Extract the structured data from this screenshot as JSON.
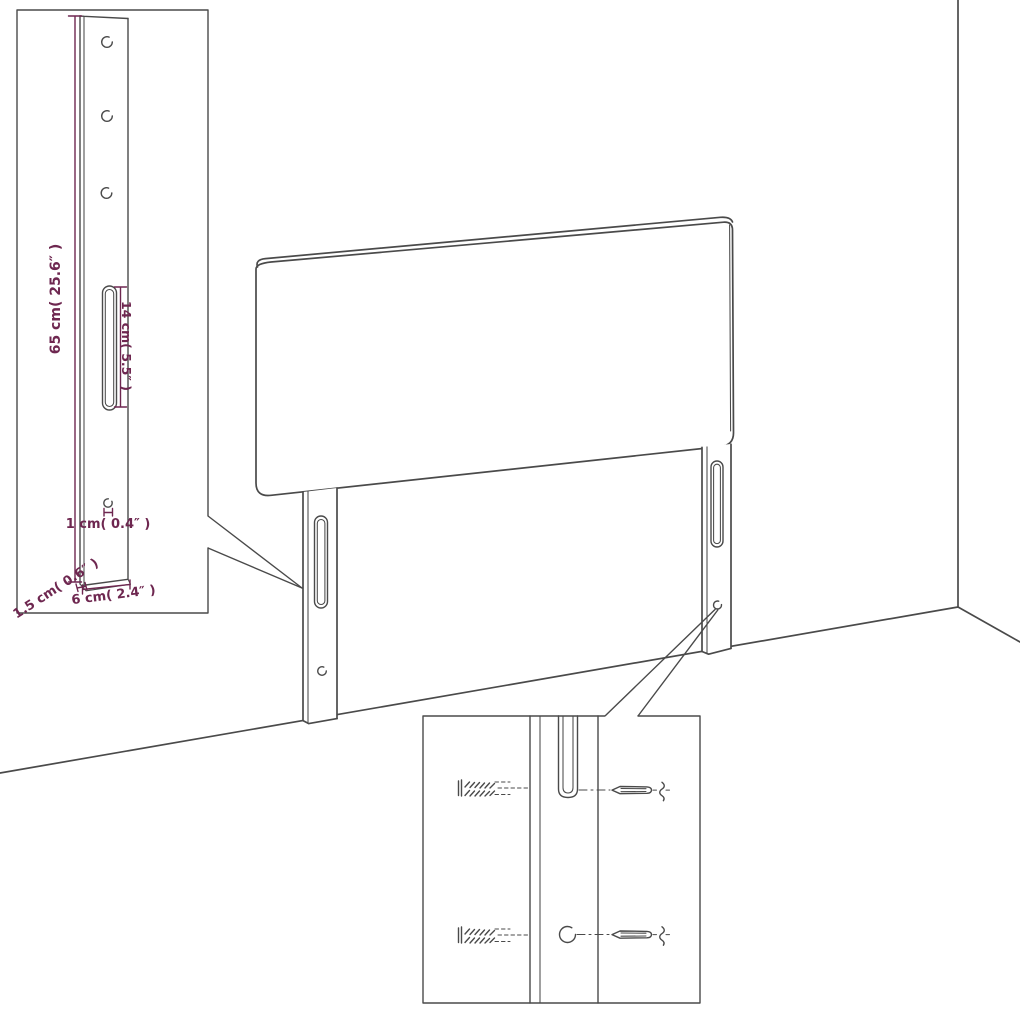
{
  "title": "Headboard with legs — dimension and wall-mounting diagram",
  "colors": {
    "background": "#ffffff",
    "line": "#4a4a4a",
    "dimension": "#6e2750"
  },
  "main_view": {
    "panel": "upholstered headboard panel",
    "left_leg": "left mounting leg with slot and screw hole",
    "right_leg": "right mounting leg with slot and screw hole",
    "room": "wall corner and floor perspective lines"
  },
  "leg_detail_inset": {
    "labels": {
      "leg_height": "65 cm( 25.6″ )",
      "slot_length": "14 cm( 5.5″ )",
      "hole_width": "1 cm( 0.4″ )",
      "leg_thickness": "1.5 cm( 0.6″ )",
      "leg_width": "6 cm( 2.4″ )"
    }
  },
  "mounting_detail_inset": {
    "parts": {
      "top_left": "wall plug (anchor)",
      "top_right": "screw",
      "top_center": "keyhole slot",
      "bottom_left": "wall plug (anchor)",
      "bottom_center": "round hole",
      "bottom_right": "screw"
    }
  }
}
